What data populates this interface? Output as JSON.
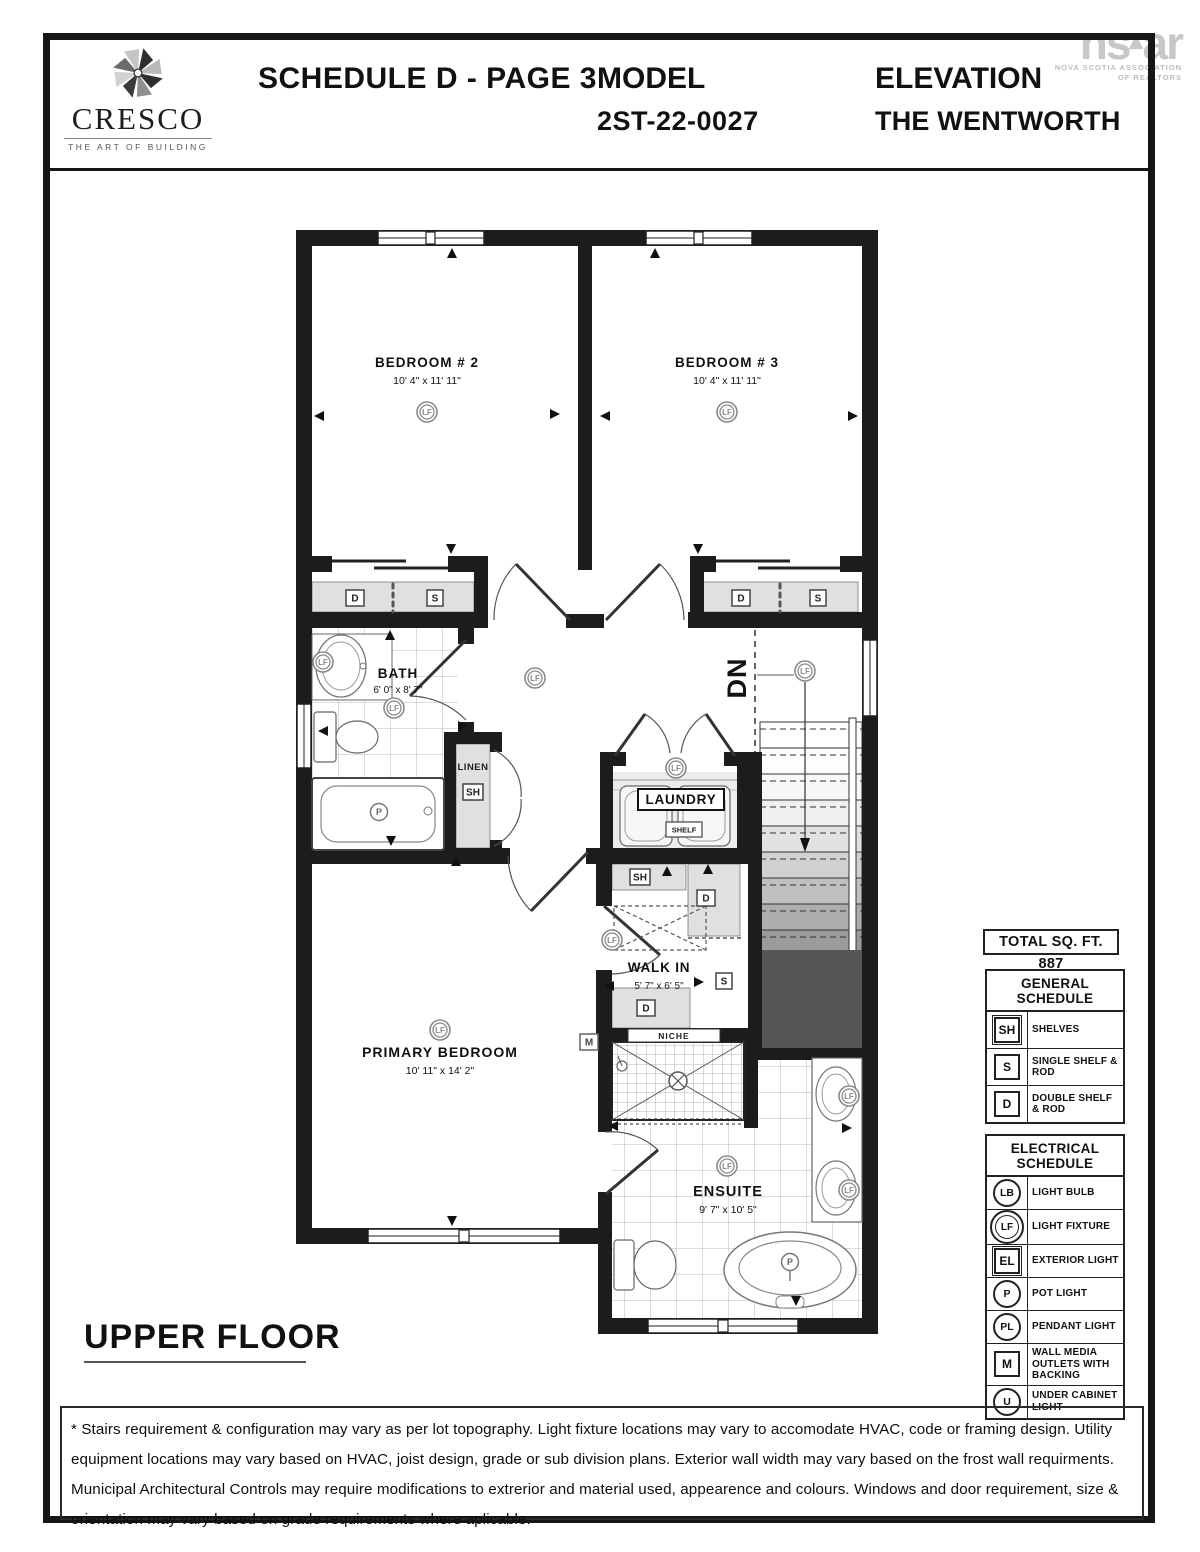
{
  "header": {
    "brand": {
      "name": "CRESCO",
      "tagline": "THE ART OF BUILDING"
    },
    "schedule_title": "SCHEDULE D - PAGE 3",
    "model_label": "MODEL",
    "model_value": "2ST-22-0027",
    "elevation_label": "ELEVATION",
    "elevation_value": "THE WENTWORTH",
    "nsar": {
      "wordmark_left": "ns",
      "wordmark_caret": "▴",
      "wordmark_right": "ar",
      "org_line1": "NOVA SCOTIA ASSOCIATION",
      "org_line2": "OF REALTORS"
    }
  },
  "plan": {
    "floor_label": "UPPER FLOOR",
    "total_sqft_label": "TOTAL SQ. FT. 887",
    "rooms": {
      "bedroom2": {
        "name": "BEDROOM # 2",
        "dims": "10' 4\" x 11' 11\""
      },
      "bedroom3": {
        "name": "BEDROOM # 3",
        "dims": "10' 4\" x 11' 11\""
      },
      "bath": {
        "name": "BATH",
        "dims": "6' 0\" x 8' 7\""
      },
      "linen": {
        "name": "LINEN"
      },
      "laundry": {
        "name": "LAUNDRY",
        "shelf_label": "SHELF"
      },
      "walk_in": {
        "name": "WALK IN",
        "dims": "5' 7\" x 6' 5\""
      },
      "primary_bedroom": {
        "name": "PRIMARY BEDROOM",
        "dims": "10' 11\" x 14' 2\""
      },
      "ensuite": {
        "name": "ENSUITE",
        "dims": "9' 7\" x 10' 5\""
      },
      "niche_label": "NICHE",
      "stairs_label": "DN"
    },
    "symbols": {
      "lf": "LF",
      "p": "P",
      "d": "D",
      "s": "S",
      "sh": "SH",
      "m": "M"
    }
  },
  "general_schedule": {
    "title": "GENERAL SCHEDULE",
    "rows": [
      {
        "symbol": "SH",
        "shape": "square",
        "label": "SHELVES"
      },
      {
        "symbol": "S",
        "shape": "square",
        "label": "SINGLE SHELF & ROD"
      },
      {
        "symbol": "D",
        "shape": "square",
        "label": "DOUBLE SHELF & ROD"
      }
    ]
  },
  "electrical_schedule": {
    "title": "ELECTRICAL SCHEDULE",
    "rows": [
      {
        "symbol": "LB",
        "shape": "circle",
        "label": "LIGHT BULB"
      },
      {
        "symbol": "LF",
        "shape": "double-circle",
        "label": "LIGHT FIXTURE"
      },
      {
        "symbol": "EL",
        "shape": "square",
        "label": "EXTERIOR LIGHT"
      },
      {
        "symbol": "P",
        "shape": "circle",
        "label": "POT LIGHT"
      },
      {
        "symbol": "PL",
        "shape": "circle",
        "label": "PENDANT LIGHT"
      },
      {
        "symbol": "M",
        "shape": "square",
        "label": "WALL MEDIA OUTLETS WITH BACKING"
      },
      {
        "symbol": "U",
        "shape": "circle",
        "label": "UNDER CABINET LIGHT"
      }
    ]
  },
  "footer": {
    "disclaimer": "* Stairs requirement & configuration may vary as per lot topography. Light fixture locations may vary to accomodate HVAC, code or framing design. Utility equipment locations may vary based on HVAC, joist design, grade or sub division plans. Exterior wall width may vary based on the frost wall requirments. Municipal Architectural Controls may require modifications to extrerior and material used, appearence and colours. Windows and door requirement, size & orientation may vary based on grade requirements where aplicable."
  },
  "colors": {
    "wall": "#1c1c1c",
    "shelf_fill": "#e0e0e0",
    "void_fill": "#565656",
    "symbol_gray": "#8a8a8a"
  }
}
